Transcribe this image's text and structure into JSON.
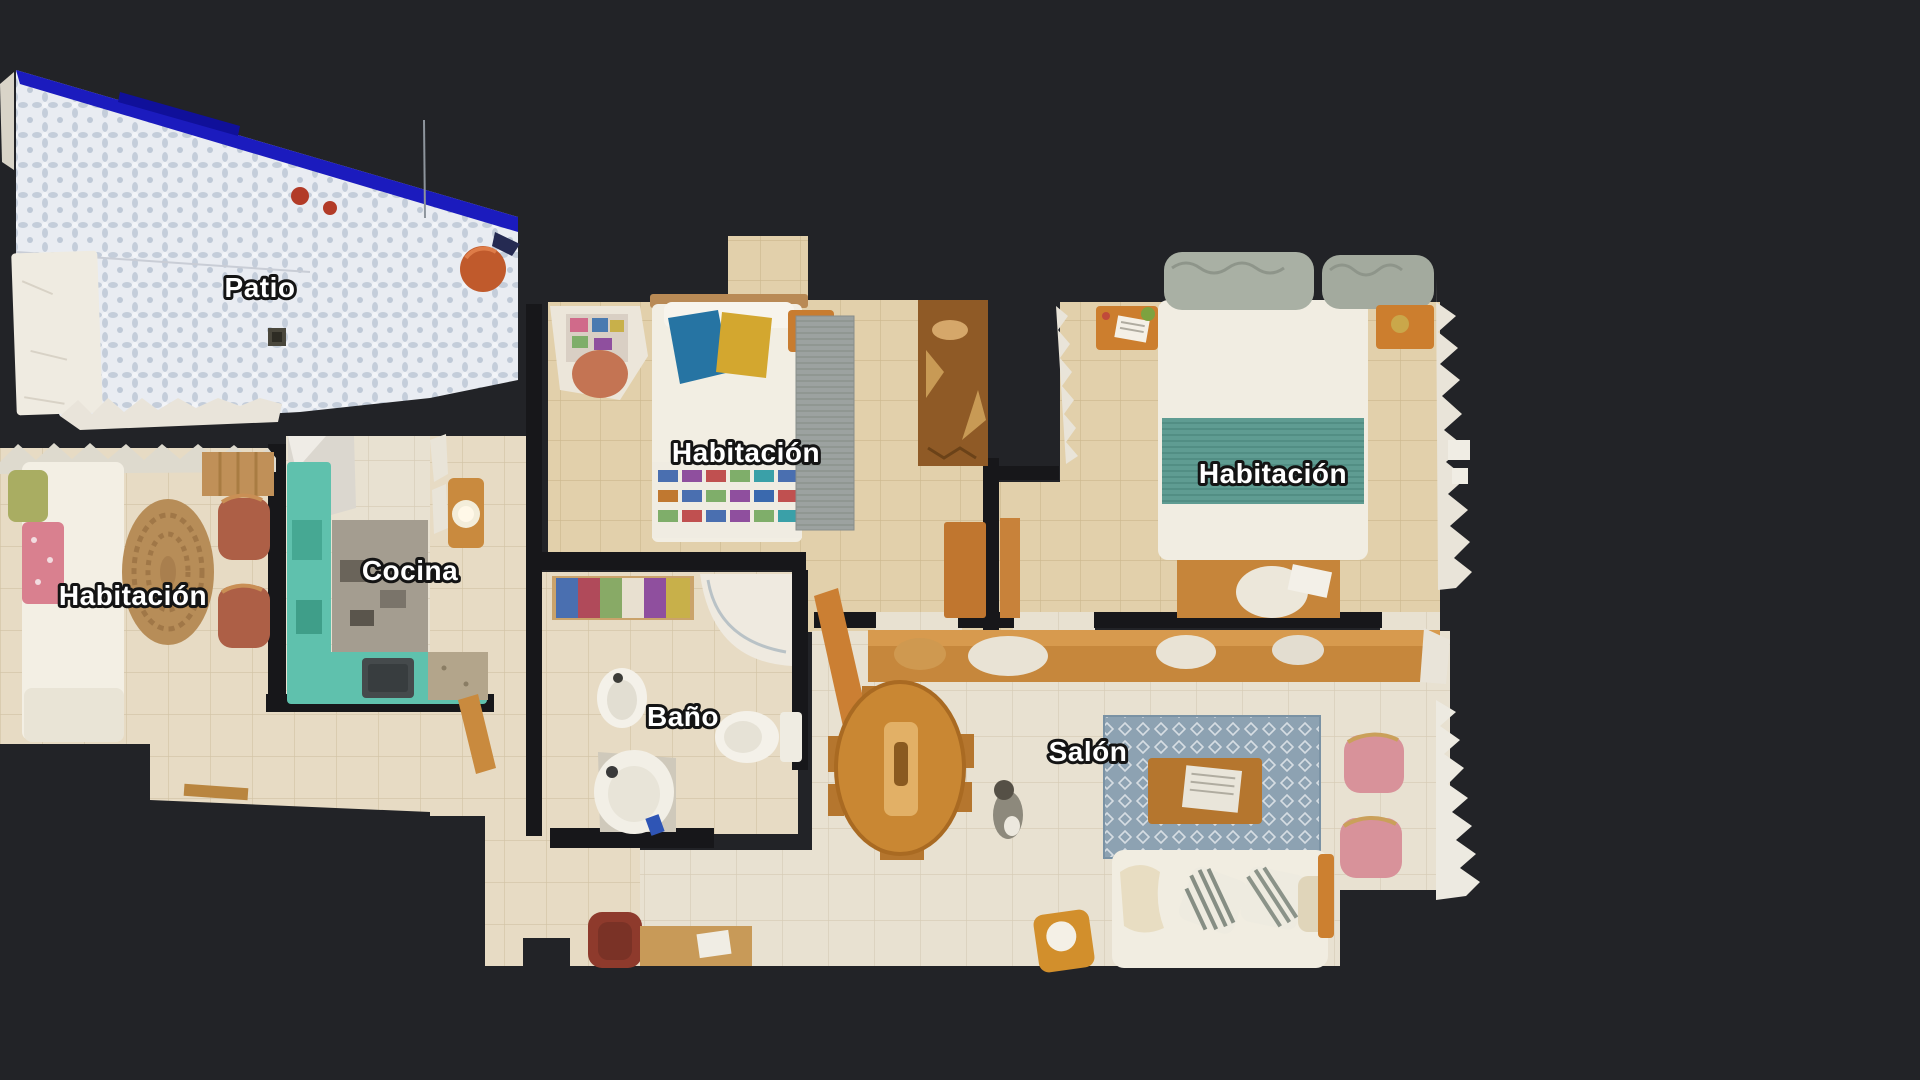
{
  "view": {
    "type": "dollhouse-floorplan-top-view",
    "background": "#222327"
  },
  "palette": {
    "wall": "#17171a",
    "floor_light": "#e8e1d1",
    "floor_tan": "#e2d0ab",
    "floor_beige": "#e7dbc4",
    "patio_tile": "#e9ecf2",
    "patio_border_blue": "#1b1bbe",
    "kitchen_counter_teal": "#5fc1ad",
    "wood_orange": "#c6873c",
    "rug_blue": "#8da2b2",
    "bed_white": "#f2eee3",
    "blanket_teal": "#5f9c92",
    "pillow_blue": "#2674a3",
    "pillow_yellow": "#d3a72f",
    "chair_pink": "#d8929a",
    "chair_terracotta": "#ad5f46",
    "label_text": "#ffffff",
    "label_outline": "#141414"
  },
  "rooms": [
    {
      "id": "patio",
      "label": "Patio"
    },
    {
      "id": "bedroom-left",
      "label": "Habitación"
    },
    {
      "id": "kitchen",
      "label": "Cocina"
    },
    {
      "id": "bedroom-middle",
      "label": "Habitación"
    },
    {
      "id": "bathroom",
      "label": "Baño"
    },
    {
      "id": "bedroom-right",
      "label": "Habitación"
    },
    {
      "id": "living-room",
      "label": "Salón"
    }
  ]
}
